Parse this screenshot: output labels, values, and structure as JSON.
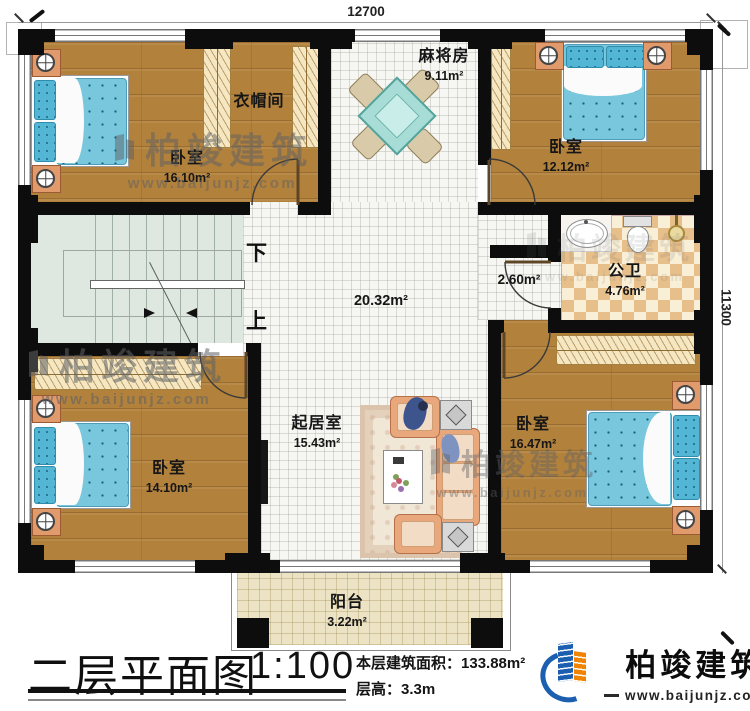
{
  "dimensions": {
    "top": "12700",
    "right": "11300"
  },
  "rooms": {
    "bedroom_tl": {
      "name": "卧室",
      "area": "16.10m²"
    },
    "cloakroom": {
      "name": "衣帽间"
    },
    "mahjong": {
      "name": "麻将房",
      "area": "9.11m²"
    },
    "bedroom_tr": {
      "name": "卧室",
      "area": "12.12m²"
    },
    "bathroom": {
      "name": "公卫",
      "area": "4.76m²"
    },
    "vestibule": {
      "area": "2.60m²"
    },
    "hall": {
      "area": "20.32m²"
    },
    "bedroom_bl": {
      "name": "卧室",
      "area": "14.10m²"
    },
    "living": {
      "name": "起居室",
      "area": "15.43m²"
    },
    "bedroom_br": {
      "name": "卧室",
      "area": "16.47m²"
    },
    "balcony": {
      "name": "阳台",
      "area": "3.22m²"
    }
  },
  "stairs": {
    "down_label": "下",
    "up_label": "上"
  },
  "title_block": {
    "title": "二层平面图",
    "scale": "1:100",
    "floor_area_label": "本层建筑面积：",
    "floor_area_value": "133.88m²",
    "floor_height_label": "层高：",
    "floor_height_value": "3.3m"
  },
  "brand": {
    "name": "柏竣建筑",
    "url": "www.baijunjz.com"
  },
  "colors": {
    "wall": "#0d0d0d",
    "wood_floor": "#b2813c",
    "tile_floor": "#f6f6f2",
    "balcony_floor": "#ebe3c4",
    "mattress_blue": "#79c7dd",
    "logo_blue": "#1c5fb0",
    "logo_orange": "#f08300"
  }
}
